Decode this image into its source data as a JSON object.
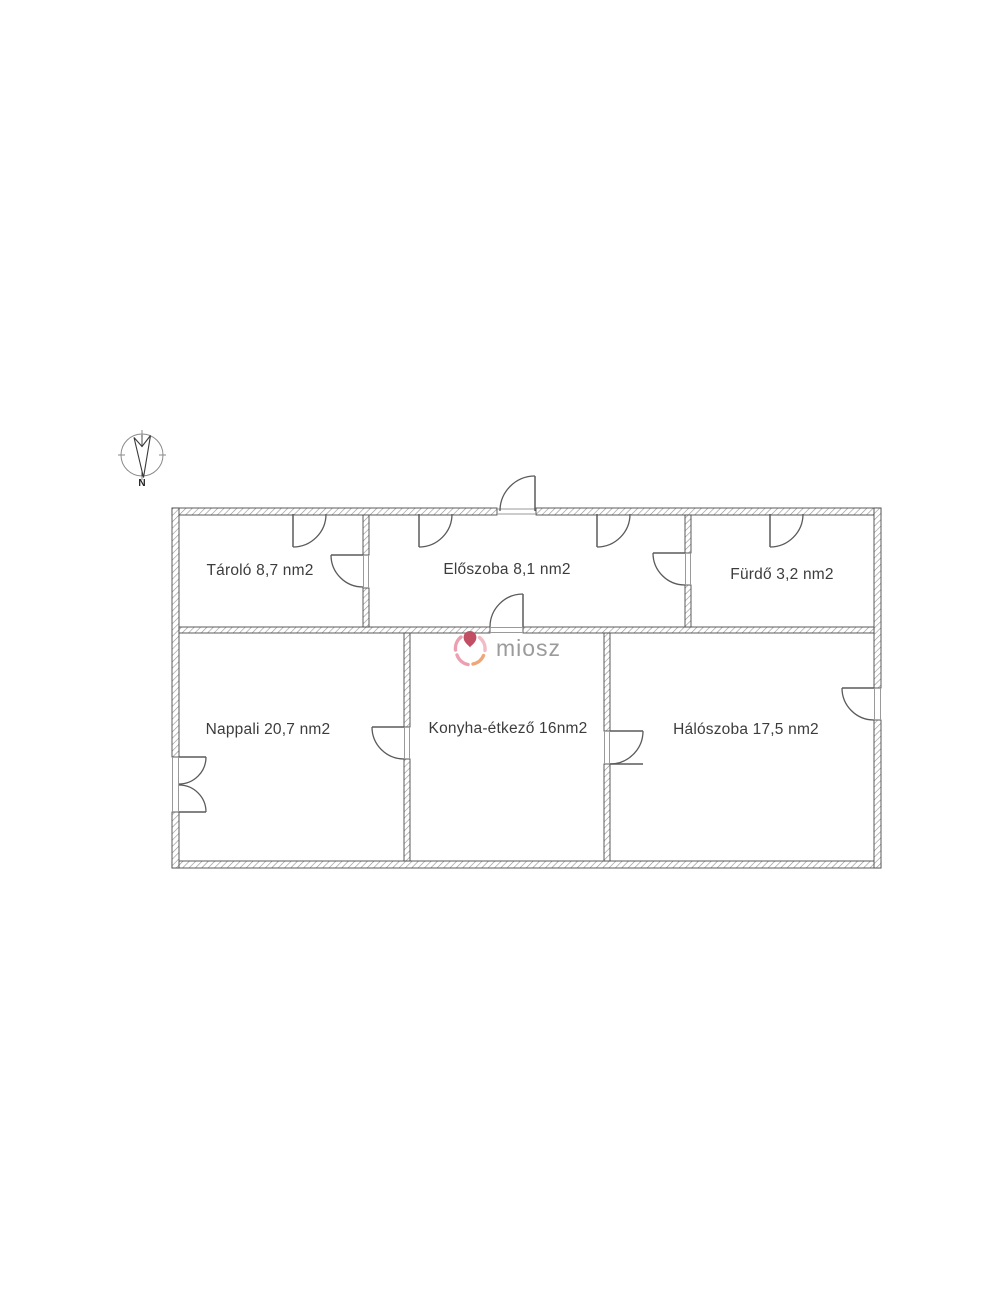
{
  "compass": {
    "north_label": "N"
  },
  "watermark": {
    "text": "miosz"
  },
  "rooms": [
    {
      "name": "tarolo",
      "label": "Tároló 8,7 nm2"
    },
    {
      "name": "eloszoba",
      "label": "Előszoba 8,1 nm2"
    },
    {
      "name": "furdo",
      "label": "Fürdő 3,2 nm2"
    },
    {
      "name": "nappali",
      "label": "Nappali 20,7 nm2"
    },
    {
      "name": "konyha_etkezo",
      "label": "Konyha-étkező 16nm2"
    },
    {
      "name": "haloszoba",
      "label": "Hálószoba 17,5 nm2"
    }
  ],
  "colors": {
    "wall_stroke": "#4a4a4a",
    "wall_hatch": "#8f8f8f",
    "door_stroke": "#5a5a5a",
    "threshold": "#9a9a9a",
    "label_text": "#3c3c3c",
    "watermark_text": "#9b9b9b",
    "logo_red": "#c24e63",
    "logo_pink": "#ec9fb0",
    "logo_light_pink": "#f2bcc6",
    "logo_orange": "#eda778"
  }
}
